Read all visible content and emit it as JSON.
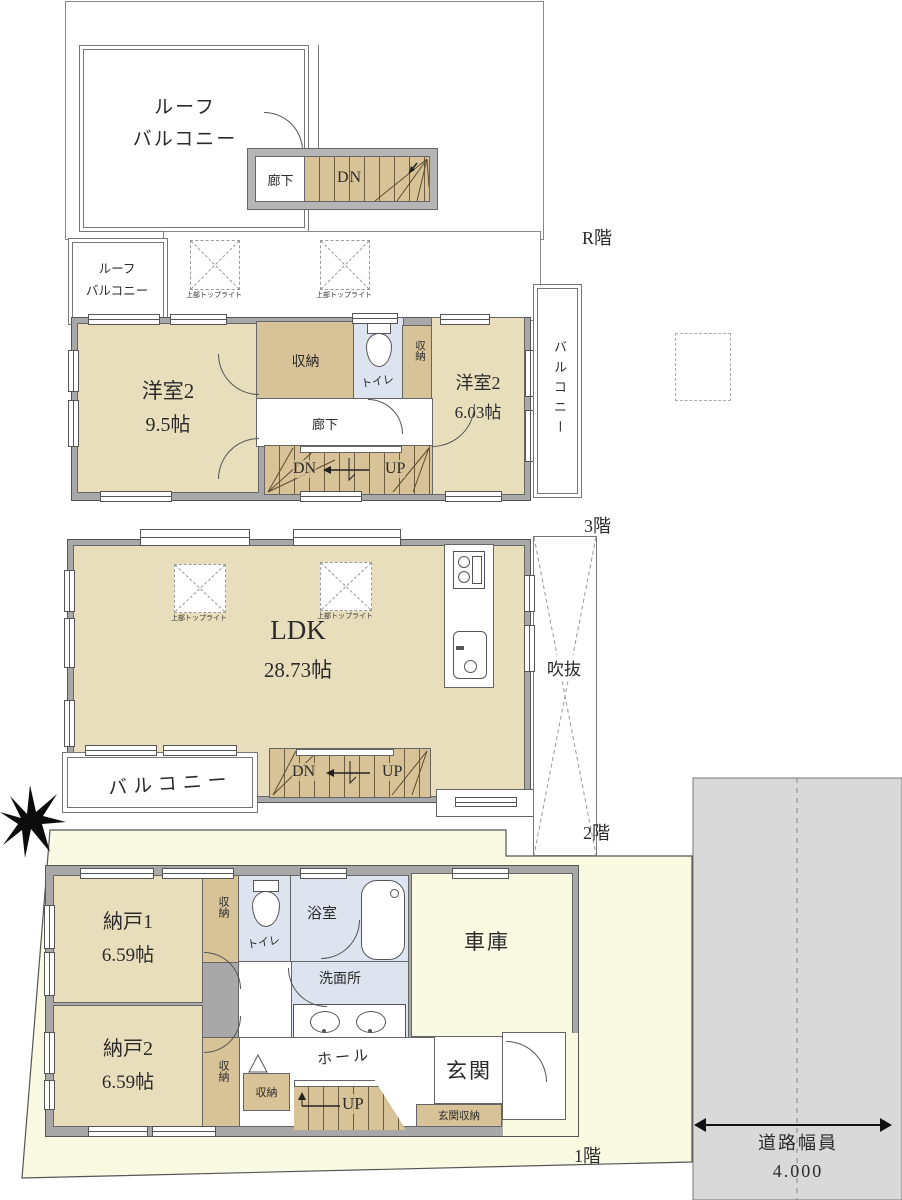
{
  "floor_tags": {
    "roof": "R階",
    "third": "3階",
    "second": "2階",
    "first": "1階"
  },
  "labels": {
    "roof_balcony_line1": "ルーフ",
    "roof_balcony_line2": "バルコニー",
    "corridor": "廊下",
    "dn": "DN",
    "up": "UP",
    "storage": "収納",
    "toilet": "トイレ",
    "balcony": "バルコニー",
    "skylight": "上部トップライト",
    "void": "吹抜",
    "bath": "浴室",
    "washroom": "洗面所",
    "garage": "車庫",
    "hall": "ホール",
    "entrance": "玄関",
    "entrance_storage": "玄関収納"
  },
  "rooms": {
    "third_west1": {
      "name": "洋室2",
      "size": "9.5帖"
    },
    "third_west2": {
      "name": "洋室2",
      "size": "6.03帖"
    },
    "second_ldk": {
      "name": "LDK",
      "size": "28.73帖"
    },
    "first_storage1": {
      "name": "納戸1",
      "size": "6.59帖"
    },
    "first_storage2": {
      "name": "納戸2",
      "size": "6.59帖"
    }
  },
  "road": {
    "name": "道路幅員",
    "width": "4.000"
  },
  "colors": {
    "room": "#e9debc",
    "closet": "#d8c298",
    "wet": "#dde4ef",
    "wall": "#a8a8a8",
    "lot": "#fafae3",
    "road": "#d9d9d9",
    "line": "#555555"
  }
}
